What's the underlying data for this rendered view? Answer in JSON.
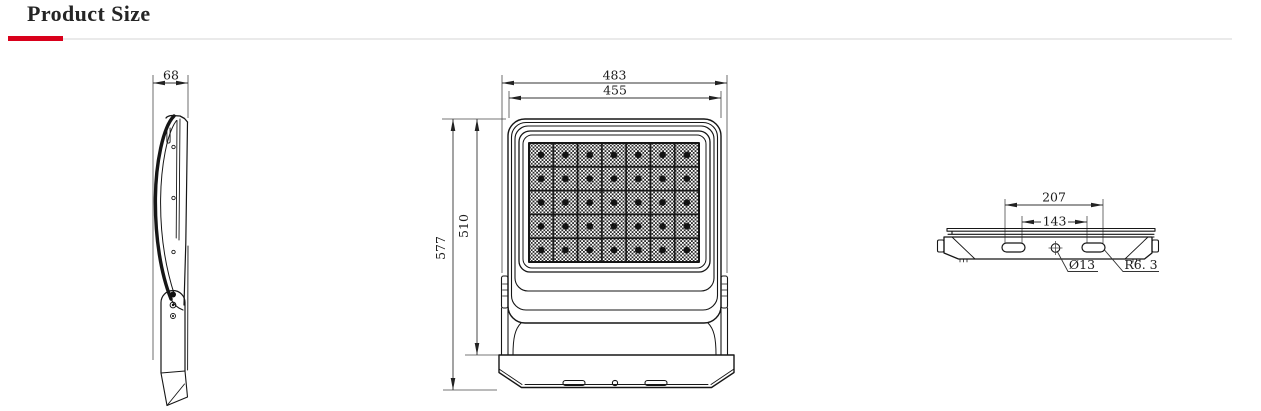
{
  "header": {
    "title": "Product Size"
  },
  "theme": {
    "accent_red": "#d9001b",
    "divider_gray": "#eaeaea",
    "drawing_line": "#1a1a1a",
    "background": "#ffffff"
  },
  "views": {
    "side": {
      "dims": {
        "depth": "68"
      }
    },
    "front": {
      "dims": {
        "outer_width": "483",
        "lens_width": "455",
        "overall_height": "577",
        "body_height": "510"
      }
    },
    "top": {
      "dims": {
        "slot_span_outer": "207",
        "slot_span_inner": "143",
        "hole_diameter": "Ø13",
        "slot_end_radius": "R6. 3"
      }
    }
  }
}
